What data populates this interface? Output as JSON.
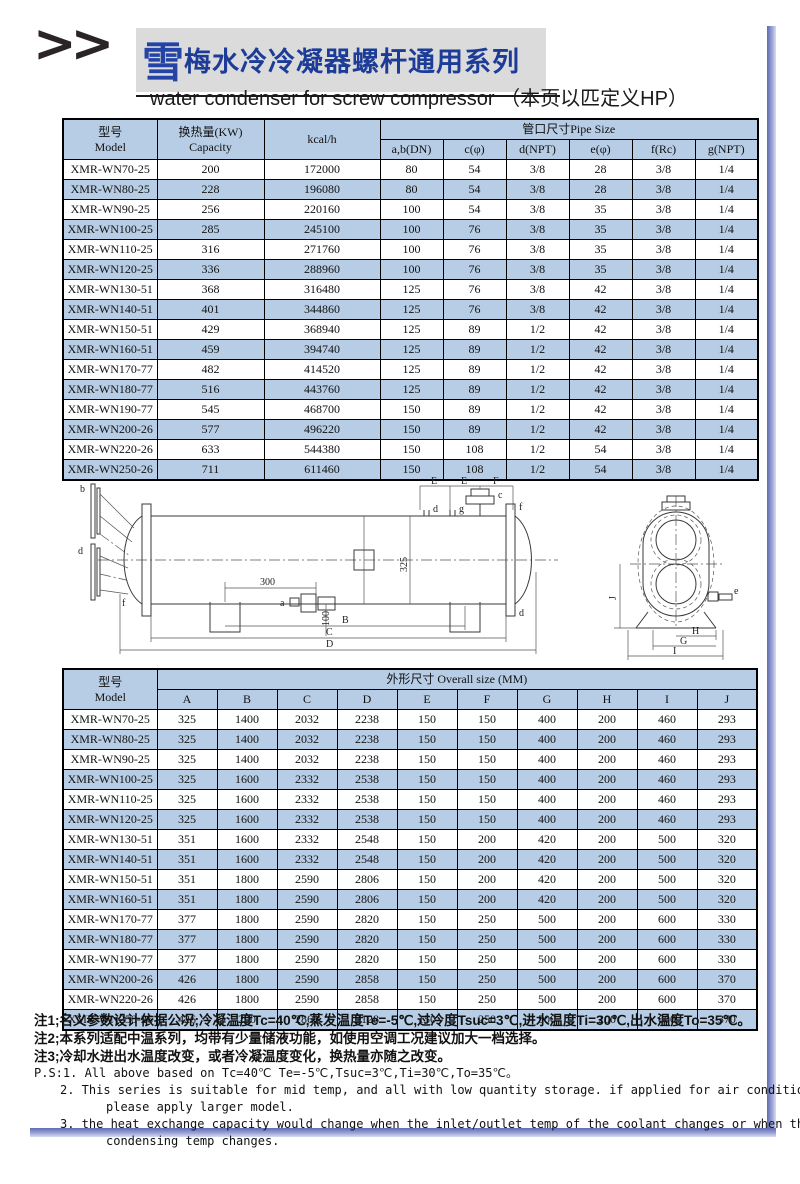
{
  "header": {
    "chevrons": ">>",
    "logo_char": "雪",
    "title_cn": "梅水冷冷凝器螺杆通用系列",
    "subtitle_en": "water condenser for screw compressor （本页以匹定义HP）"
  },
  "colors": {
    "row_blue": "#b7cde5",
    "title_blue": "#1c3c97",
    "frame_shadow_blue": "#5f6ab1",
    "title_bg_gray": "#dbdbdb"
  },
  "table1": {
    "header": {
      "model_cn": "型号",
      "model_en": "Model",
      "capacity_cn": "换热量(KW)",
      "capacity_en": "Capacity",
      "kcal": "kcal/h",
      "pipe_size": "管口尺寸Pipe Size",
      "subcols": [
        "a,b(DN)",
        "c(φ)",
        "d(NPT)",
        "e(φ)",
        "f(Rc)",
        "g(NPT)"
      ]
    },
    "rows": [
      [
        "XMR-WN70-25",
        "200",
        "172000",
        "80",
        "54",
        "3/8",
        "28",
        "3/8",
        "1/4"
      ],
      [
        "XMR-WN80-25",
        "228",
        "196080",
        "80",
        "54",
        "3/8",
        "28",
        "3/8",
        "1/4"
      ],
      [
        "XMR-WN90-25",
        "256",
        "220160",
        "100",
        "54",
        "3/8",
        "35",
        "3/8",
        "1/4"
      ],
      [
        "XMR-WN100-25",
        "285",
        "245100",
        "100",
        "76",
        "3/8",
        "35",
        "3/8",
        "1/4"
      ],
      [
        "XMR-WN110-25",
        "316",
        "271760",
        "100",
        "76",
        "3/8",
        "35",
        "3/8",
        "1/4"
      ],
      [
        "XMR-WN120-25",
        "336",
        "288960",
        "100",
        "76",
        "3/8",
        "35",
        "3/8",
        "1/4"
      ],
      [
        "XMR-WN130-51",
        "368",
        "316480",
        "125",
        "76",
        "3/8",
        "42",
        "3/8",
        "1/4"
      ],
      [
        "XMR-WN140-51",
        "401",
        "344860",
        "125",
        "76",
        "3/8",
        "42",
        "3/8",
        "1/4"
      ],
      [
        "XMR-WN150-51",
        "429",
        "368940",
        "125",
        "89",
        "1/2",
        "42",
        "3/8",
        "1/4"
      ],
      [
        "XMR-WN160-51",
        "459",
        "394740",
        "125",
        "89",
        "1/2",
        "42",
        "3/8",
        "1/4"
      ],
      [
        "XMR-WN170-77",
        "482",
        "414520",
        "125",
        "89",
        "1/2",
        "42",
        "3/8",
        "1/4"
      ],
      [
        "XMR-WN180-77",
        "516",
        "443760",
        "125",
        "89",
        "1/2",
        "42",
        "3/8",
        "1/4"
      ],
      [
        "XMR-WN190-77",
        "545",
        "468700",
        "150",
        "89",
        "1/2",
        "42",
        "3/8",
        "1/4"
      ],
      [
        "XMR-WN200-26",
        "577",
        "496220",
        "150",
        "89",
        "1/2",
        "42",
        "3/8",
        "1/4"
      ],
      [
        "XMR-WN220-26",
        "633",
        "544380",
        "150",
        "108",
        "1/2",
        "54",
        "3/8",
        "1/4"
      ],
      [
        "XMR-WN250-26",
        "711",
        "611460",
        "150",
        "108",
        "1/2",
        "54",
        "3/8",
        "1/4"
      ]
    ]
  },
  "diagram": {
    "dim_e1": "E",
    "dim_e2": "E",
    "dim_f": "F",
    "dim_300": "300",
    "dim_100": "100",
    "dim_325": "325",
    "dim_b": "B",
    "dim_c": "C",
    "dim_d": "D",
    "dim_h": "H",
    "dim_g": "G",
    "dim_i": "I",
    "dim_j": "J",
    "port_b": "b",
    "port_d": "d",
    "port_f": "f",
    "port_a": "a",
    "port_c": "c",
    "port_d2": "d",
    "port_g": "g",
    "port_e": "e",
    "port_f2": "f",
    "port_d3": "d"
  },
  "table2": {
    "header": {
      "model_cn": "型号",
      "model_en": "Model",
      "overall": "外形尺寸 Overall size (MM)",
      "subcols": [
        "A",
        "B",
        "C",
        "D",
        "E",
        "F",
        "G",
        "H",
        "I",
        "J"
      ]
    },
    "rows": [
      [
        "XMR-WN70-25",
        "325",
        "1400",
        "2032",
        "2238",
        "150",
        "150",
        "400",
        "200",
        "460",
        "293"
      ],
      [
        "XMR-WN80-25",
        "325",
        "1400",
        "2032",
        "2238",
        "150",
        "150",
        "400",
        "200",
        "460",
        "293"
      ],
      [
        "XMR-WN90-25",
        "325",
        "1400",
        "2032",
        "2238",
        "150",
        "150",
        "400",
        "200",
        "460",
        "293"
      ],
      [
        "XMR-WN100-25",
        "325",
        "1600",
        "2332",
        "2538",
        "150",
        "150",
        "400",
        "200",
        "460",
        "293"
      ],
      [
        "XMR-WN110-25",
        "325",
        "1600",
        "2332",
        "2538",
        "150",
        "150",
        "400",
        "200",
        "460",
        "293"
      ],
      [
        "XMR-WN120-25",
        "325",
        "1600",
        "2332",
        "2538",
        "150",
        "150",
        "400",
        "200",
        "460",
        "293"
      ],
      [
        "XMR-WN130-51",
        "351",
        "1600",
        "2332",
        "2548",
        "150",
        "200",
        "420",
        "200",
        "500",
        "320"
      ],
      [
        "XMR-WN140-51",
        "351",
        "1600",
        "2332",
        "2548",
        "150",
        "200",
        "420",
        "200",
        "500",
        "320"
      ],
      [
        "XMR-WN150-51",
        "351",
        "1800",
        "2590",
        "2806",
        "150",
        "200",
        "420",
        "200",
        "500",
        "320"
      ],
      [
        "XMR-WN160-51",
        "351",
        "1800",
        "2590",
        "2806",
        "150",
        "200",
        "420",
        "200",
        "500",
        "320"
      ],
      [
        "XMR-WN170-77",
        "377",
        "1800",
        "2590",
        "2820",
        "150",
        "250",
        "500",
        "200",
        "600",
        "330"
      ],
      [
        "XMR-WN180-77",
        "377",
        "1800",
        "2590",
        "2820",
        "150",
        "250",
        "500",
        "200",
        "600",
        "330"
      ],
      [
        "XMR-WN190-77",
        "377",
        "1800",
        "2590",
        "2820",
        "150",
        "250",
        "500",
        "200",
        "600",
        "330"
      ],
      [
        "XMR-WN200-26",
        "426",
        "1800",
        "2590",
        "2858",
        "150",
        "250",
        "500",
        "200",
        "600",
        "370"
      ],
      [
        "XMR-WN220-26",
        "426",
        "1800",
        "2590",
        "2858",
        "150",
        "250",
        "500",
        "200",
        "600",
        "370"
      ],
      [
        "XMR-WN250-26",
        "426",
        "200",
        "2860",
        "3128",
        "150",
        "250",
        "500",
        "200",
        "600",
        "370"
      ]
    ]
  },
  "notes": {
    "note1": "注1;名义参数设计依据公况;冷凝温度Tc=40℃,蒸发温度Te=-5℃,过冷度Tsuc=3℃,进水温度Ti=30℃,出水温度To=35℃。",
    "note2": "注2;本系列适配中温系列，均带有少量储液功能，如使用空调工况建议加大一档选择。",
    "note3": "注3;冷却水进出水温度改变，或者冷凝温度变化，换热量亦随之改变。",
    "ps1": "P.S:1. All above based on Tc=40℃ Te=-5℃,Tsuc=3℃,Ti=30℃,To=35℃。",
    "ps2a": "2. This series is suitable for mid temp, and all with low quantity storage. if applied for air conditioning,",
    "ps2b": "please apply larger model.",
    "ps3a": "3. the heat exchange capacity would change when the inlet/outlet temp of the coolant changes or when the",
    "ps3b": "condensing temp changes."
  }
}
